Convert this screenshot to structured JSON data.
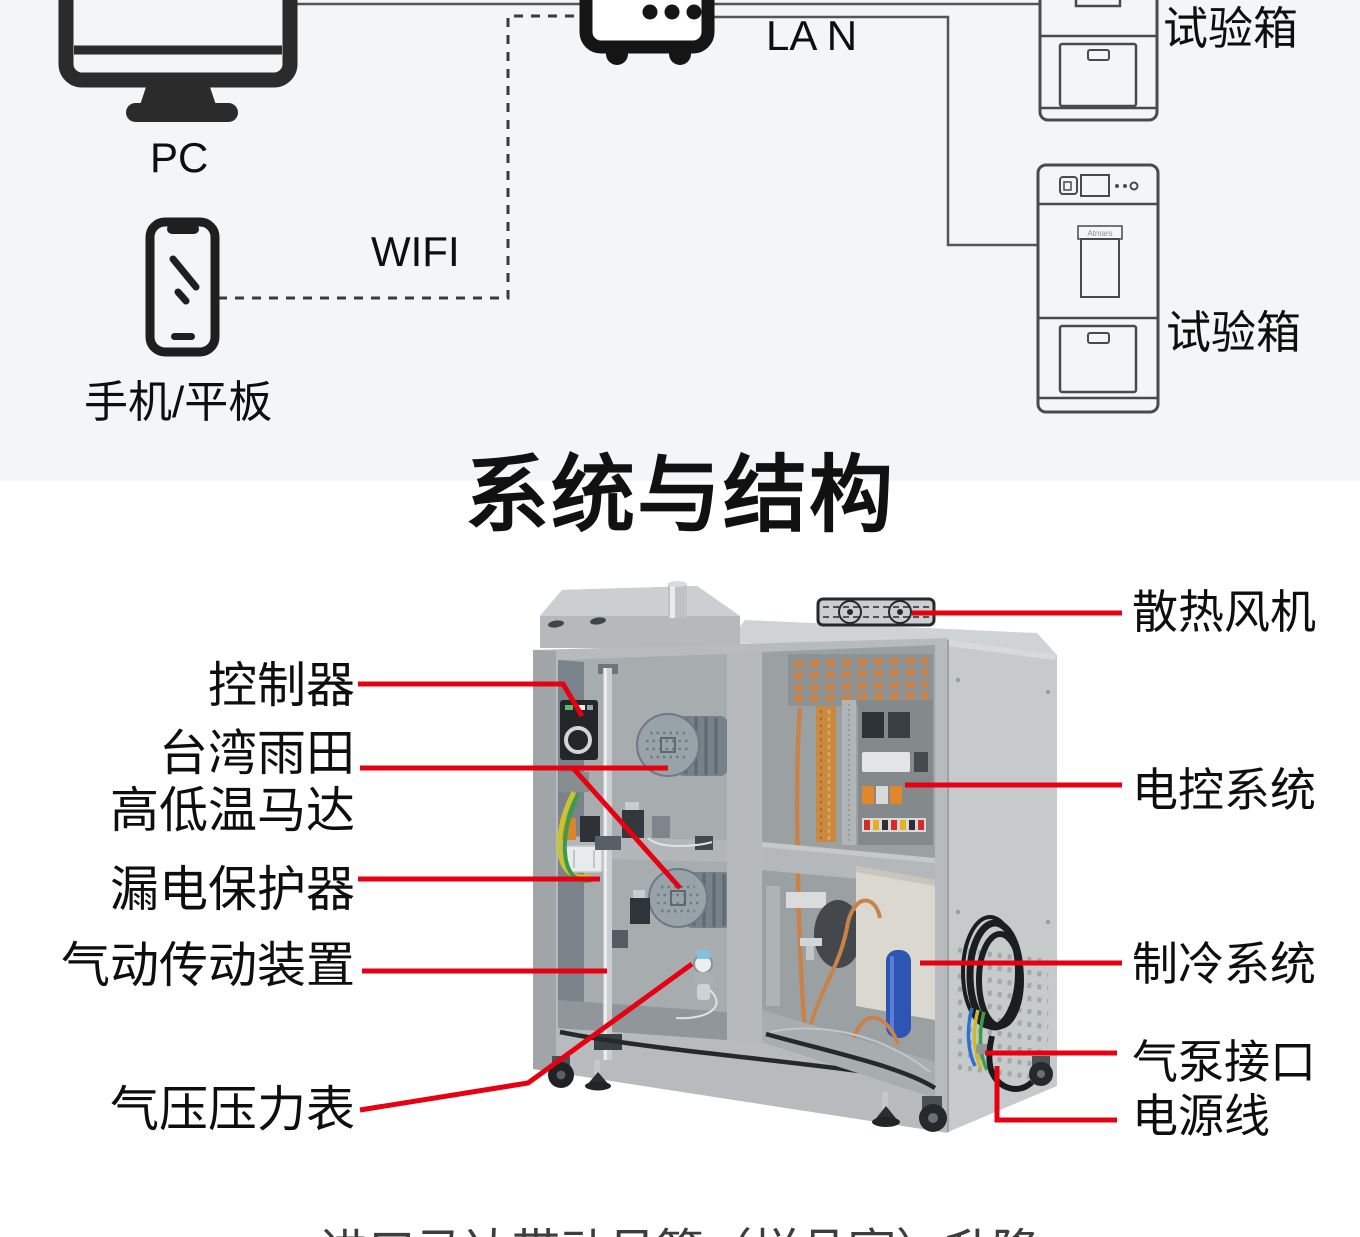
{
  "colors": {
    "accent_red": "#e60012",
    "section_bg": "#f4f5f6",
    "ink": "#141414"
  },
  "network_diagram": {
    "pc": {
      "label": "PC"
    },
    "phone": {
      "label": "手机/平板"
    },
    "wifi": {
      "label": "WIFI"
    },
    "lan": {
      "label": "LA N"
    },
    "chambers": [
      {
        "label": "试验箱"
      },
      {
        "label": "试验箱",
        "brand": "Atmars"
      }
    ]
  },
  "section_title": "系统与结构",
  "machine": {
    "callouts_left": [
      {
        "id": "controller",
        "label": "控制器"
      },
      {
        "id": "motor",
        "line1": "台湾雨田",
        "line2": "高低温马达"
      },
      {
        "id": "leakage-protector",
        "label": "漏电保护器"
      },
      {
        "id": "pneumatic-drive",
        "label": "气动传动装置"
      },
      {
        "id": "pressure-gauge",
        "label": "气压压力表"
      }
    ],
    "callouts_right": [
      {
        "id": "cooling-fan",
        "label": "散热风机"
      },
      {
        "id": "electric-control",
        "label": "电控系统"
      },
      {
        "id": "refrigeration",
        "label": "制冷系统"
      },
      {
        "id": "air-pump-port",
        "label": "气泵接口"
      },
      {
        "id": "power-cord",
        "label": "电源线"
      }
    ]
  },
  "caption": "进口马达带动吊篮（样品室）升降"
}
